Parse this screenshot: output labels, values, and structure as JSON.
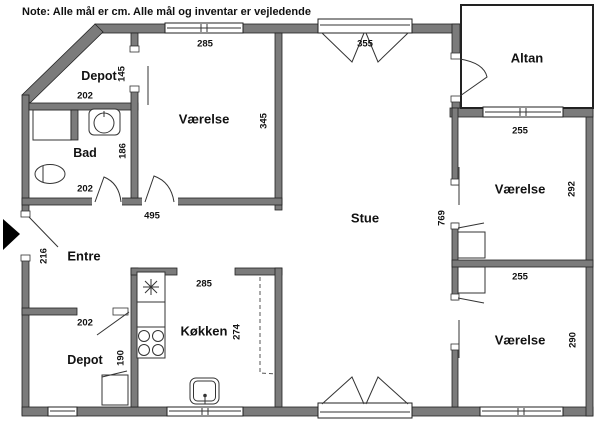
{
  "note": "Note: Alle mål er cm. Alle mål og inventar er vejledende",
  "rooms": {
    "depot_top": "Depot",
    "vaerelse_top": "Værelse",
    "bad": "Bad",
    "entre": "Entre",
    "depot_bottom": "Depot",
    "koekken": "Køkken",
    "stue": "Stue",
    "altan": "Altan",
    "vaerelse_right_top": "Værelse",
    "vaerelse_right_bottom": "Værelse"
  },
  "dims": {
    "vaerelse_top_width": "285",
    "stue_top_door": "355",
    "depot_top_h": "145",
    "depot_top_w": "202",
    "vaerelse_top_h": "345",
    "bad_h": "186",
    "bad_w": "202",
    "hall_w": "495",
    "entrance_h": "216",
    "depot_bottom_door": "202",
    "depot_bottom_h": "190",
    "koekken_w": "285",
    "koekken_h": "274",
    "stue_h": "769",
    "vr_top_w": "255",
    "vr_top_h": "292",
    "vr_bottom_w": "255",
    "vr_bottom_h": "290"
  },
  "colors": {
    "wall": "#7b7b7b",
    "outline": "#222222",
    "background": "#ffffff",
    "text": "#111111"
  }
}
